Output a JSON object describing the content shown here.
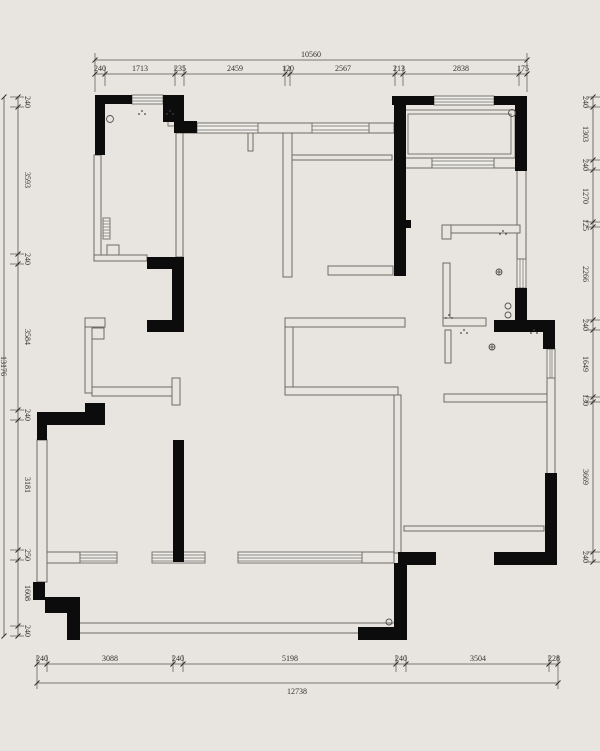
{
  "drawing": {
    "type": "residential floor plan",
    "colors": {
      "background": "#e8e5e1",
      "structural_wall": "#0c0c0c",
      "partition_stroke": "#6e6a63",
      "dimension_line": "#55524c",
      "dimension_text": "#33312c",
      "window_fill": "#efedea"
    }
  },
  "dims": {
    "top": {
      "total": "10560",
      "segments": [
        "240",
        "1713",
        "235",
        "2459",
        "120",
        "2567",
        "213",
        "2838",
        "175"
      ]
    },
    "bottom": {
      "total": "12738",
      "segments": [
        "240",
        "3088",
        "240",
        "5198",
        "240",
        "3504",
        "228"
      ]
    },
    "left": {
      "total": "13176",
      "segments": [
        "240",
        "3593",
        "240",
        "3584",
        "240",
        "3181",
        "250",
        "1608",
        "240"
      ]
    },
    "right": {
      "segments": [
        "240",
        "1303",
        "240",
        "1270",
        "125",
        "2266",
        "240",
        "1649",
        "130",
        "3669",
        "240"
      ]
    }
  }
}
